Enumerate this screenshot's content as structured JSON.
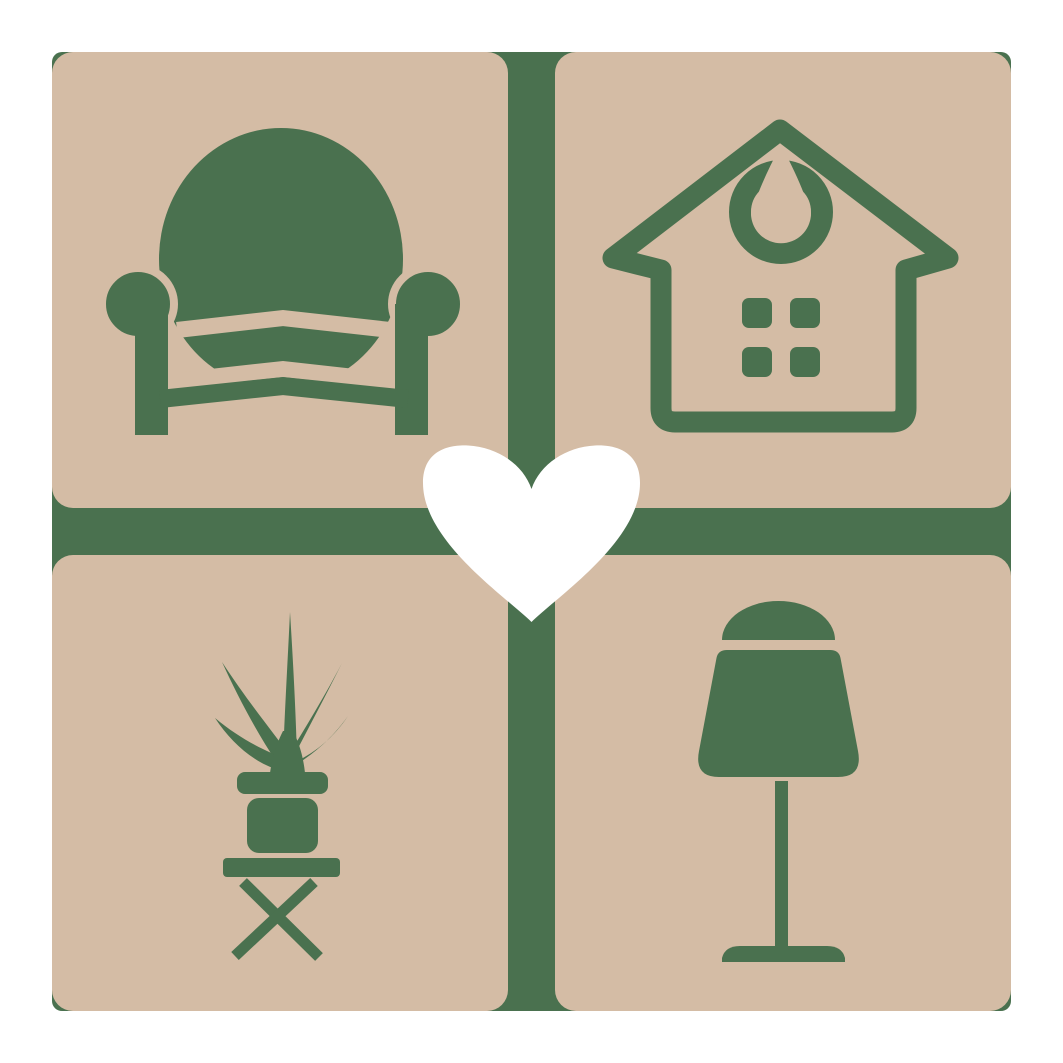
{
  "page": {
    "background": "#FFFFFF"
  },
  "logo": {
    "name": "home-and-furniture-logo",
    "label": "Home and furniture logo: four tiles with armchair, house, potted plant and lamp around a white heart",
    "colors": {
      "tile": "#D4BCA5",
      "icon": "#4A714F",
      "heart": "#FFFFFF"
    },
    "backdrop": {
      "label": "Green rounded square backdrop with cross divider"
    },
    "tiles": [
      {
        "id": "armchair",
        "label": "Armchair tile"
      },
      {
        "id": "house",
        "label": "House tile"
      },
      {
        "id": "plant",
        "label": "Potted plant on stool tile"
      },
      {
        "id": "lamp",
        "label": "Table lamp tile"
      }
    ],
    "center": {
      "id": "heart",
      "label": "White heart"
    }
  }
}
